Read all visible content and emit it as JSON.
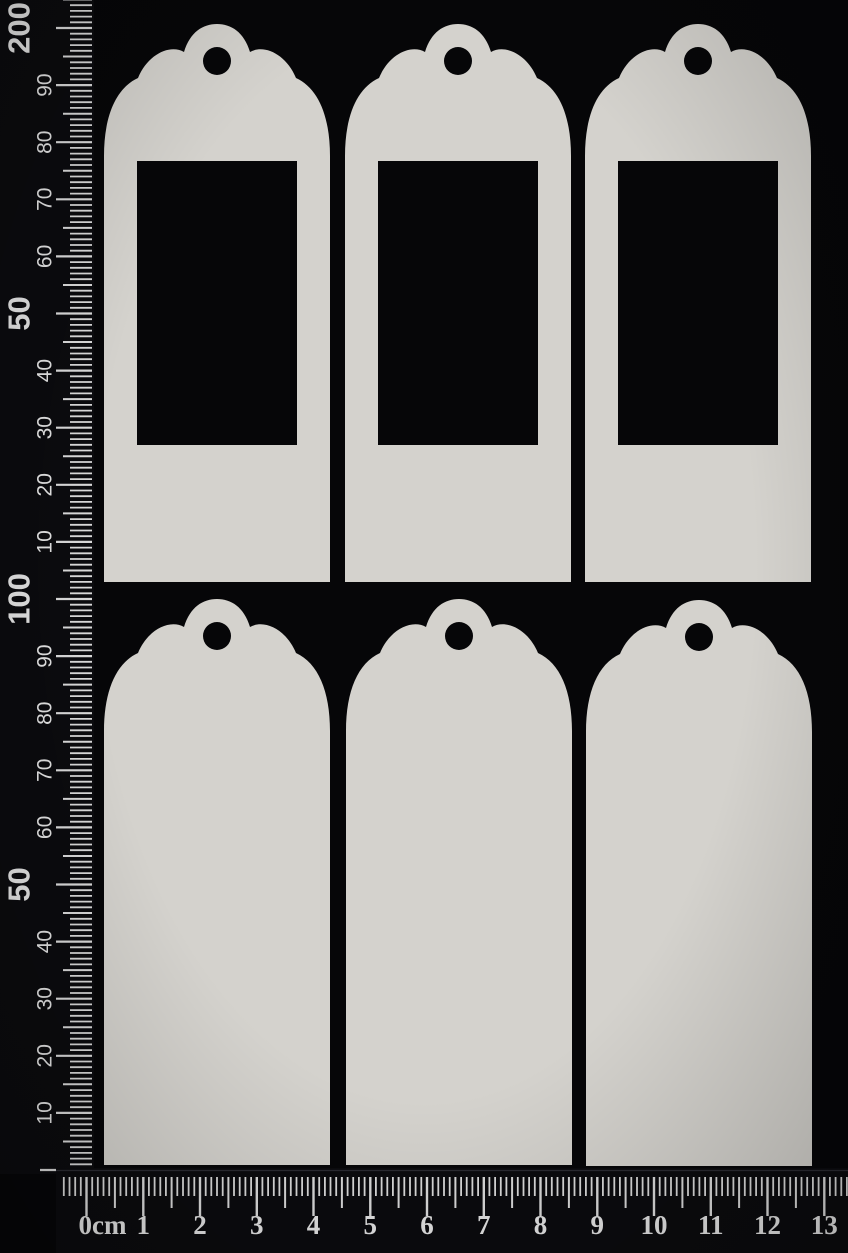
{
  "photo": {
    "subject": "Six scalloped-top chipboard tag blanks arranged in two rows of three on a black background, photographed with metric rulers",
    "tag_count": "6"
  },
  "colors": {
    "background": "#060608",
    "ruler_body": "#0b0b0e",
    "ruler_edge_highlight": "#34343c",
    "tick": "#d9d9d9",
    "label": "#e2e2e2",
    "tag": "#d4d2cd",
    "aperture": "#050507"
  },
  "tags": {
    "rows": [
      {
        "name": "aperture-tags",
        "style": "rectangular-aperture",
        "items": [
          {
            "id": "tag-1",
            "type": "aperture"
          },
          {
            "id": "tag-2",
            "type": "aperture"
          },
          {
            "id": "tag-3",
            "type": "aperture"
          }
        ]
      },
      {
        "name": "solid-tags",
        "style": "solid",
        "items": [
          {
            "id": "tag-4",
            "type": "solid"
          },
          {
            "id": "tag-5",
            "type": "solid"
          },
          {
            "id": "tag-6",
            "type": "solid"
          }
        ]
      }
    ]
  },
  "vertical_ruler": {
    "unit": "mm",
    "orientation": "vertical",
    "labels": [
      {
        "mm": 200,
        "text": "200",
        "large": true
      },
      {
        "mm": 190,
        "text": "90",
        "large": false
      },
      {
        "mm": 180,
        "text": "80",
        "large": false
      },
      {
        "mm": 170,
        "text": "70",
        "large": false
      },
      {
        "mm": 160,
        "text": "60",
        "large": false
      },
      {
        "mm": 150,
        "text": "50",
        "large": true
      },
      {
        "mm": 140,
        "text": "40",
        "large": false
      },
      {
        "mm": 130,
        "text": "30",
        "large": false
      },
      {
        "mm": 120,
        "text": "20",
        "large": false
      },
      {
        "mm": 110,
        "text": "10",
        "large": false
      },
      {
        "mm": 100,
        "text": "100",
        "large": true
      },
      {
        "mm": 90,
        "text": "90",
        "large": false
      },
      {
        "mm": 80,
        "text": "80",
        "large": false
      },
      {
        "mm": 70,
        "text": "70",
        "large": false
      },
      {
        "mm": 60,
        "text": "60",
        "large": false
      },
      {
        "mm": 50,
        "text": "50",
        "large": true
      },
      {
        "mm": 40,
        "text": "40",
        "large": false
      },
      {
        "mm": 30,
        "text": "30",
        "large": false
      },
      {
        "mm": 20,
        "text": "20",
        "large": false
      },
      {
        "mm": 10,
        "text": "10",
        "large": false
      }
    ]
  },
  "horizontal_ruler": {
    "unit": "cm",
    "orientation": "horizontal",
    "labels": [
      {
        "cm": 0,
        "text": "0cm"
      },
      {
        "cm": 1,
        "text": "1"
      },
      {
        "cm": 2,
        "text": "2"
      },
      {
        "cm": 3,
        "text": "3"
      },
      {
        "cm": 4,
        "text": "4"
      },
      {
        "cm": 5,
        "text": "5"
      },
      {
        "cm": 6,
        "text": "6"
      },
      {
        "cm": 7,
        "text": "7"
      },
      {
        "cm": 8,
        "text": "8"
      },
      {
        "cm": 9,
        "text": "9"
      },
      {
        "cm": 10,
        "text": "10"
      },
      {
        "cm": 11,
        "text": "11"
      },
      {
        "cm": 12,
        "text": "12"
      },
      {
        "cm": 13,
        "text": "13"
      }
    ]
  }
}
